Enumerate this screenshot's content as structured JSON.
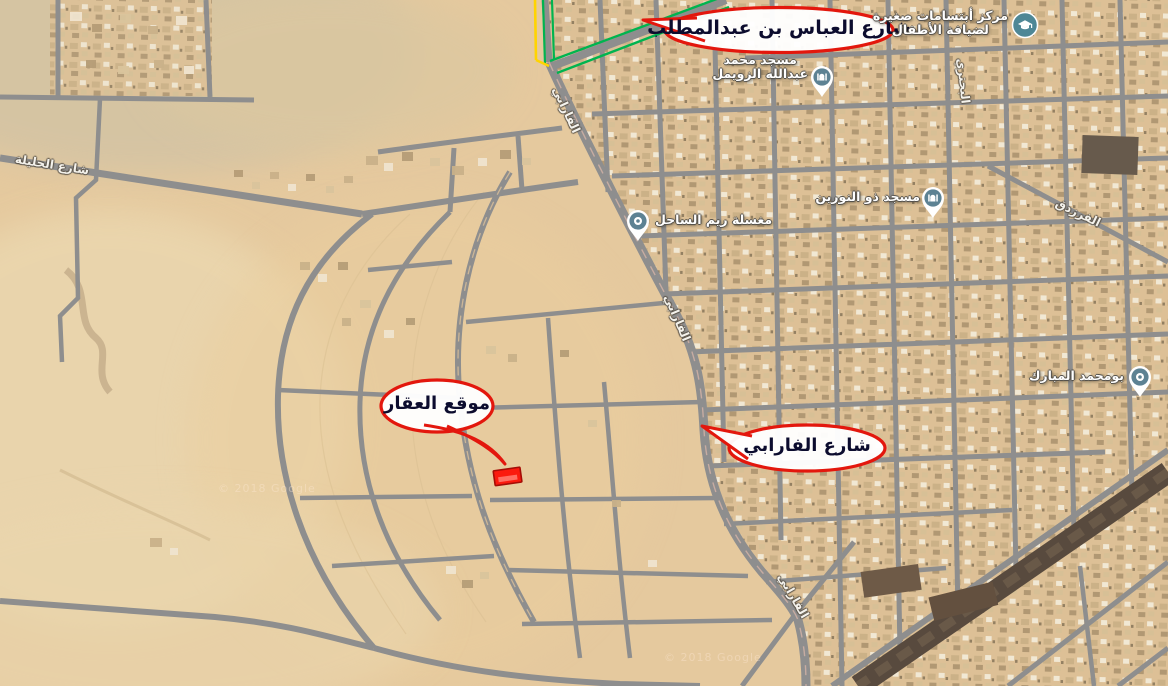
{
  "map": {
    "copyright": "© 2018 Google",
    "callouts": {
      "abbas_street": "شارع العباس بن عبدالمطلب",
      "property_location": "موقع العقار",
      "farabi_street": "شارع الفارابي"
    },
    "pois": {
      "kids_center": {
        "line1": "مركز أبتسامات صغيرة",
        "line2": "لضيافة الأطفال"
      },
      "mosque_zuwaimil": {
        "line1": "مسجد محمد",
        "line2": "عبدالله الزويمل"
      },
      "mosque_nurain": {
        "name": "مسجد ذو النورين"
      },
      "laundry_reem": {
        "name": "مغسلة ريم الساحل"
      },
      "bu_mohammad": {
        "name": "بومحمد المبارك"
      }
    },
    "road_labels": {
      "hulailah": "شارع الحليلة",
      "buhturi": "البحتري",
      "farazdaq": "الفرزدق",
      "farabi": "الفارابي"
    },
    "colors": {
      "callout_red": "#e3170d",
      "route_highlight_green": "#00b44f",
      "route_highlight_yellow": "#ffd400",
      "property_marker_red": "#fb1a0e",
      "poi_pin_slate": "#5d8293",
      "road_gray": "#8e8e8e",
      "sand": "#e5c99e"
    }
  }
}
